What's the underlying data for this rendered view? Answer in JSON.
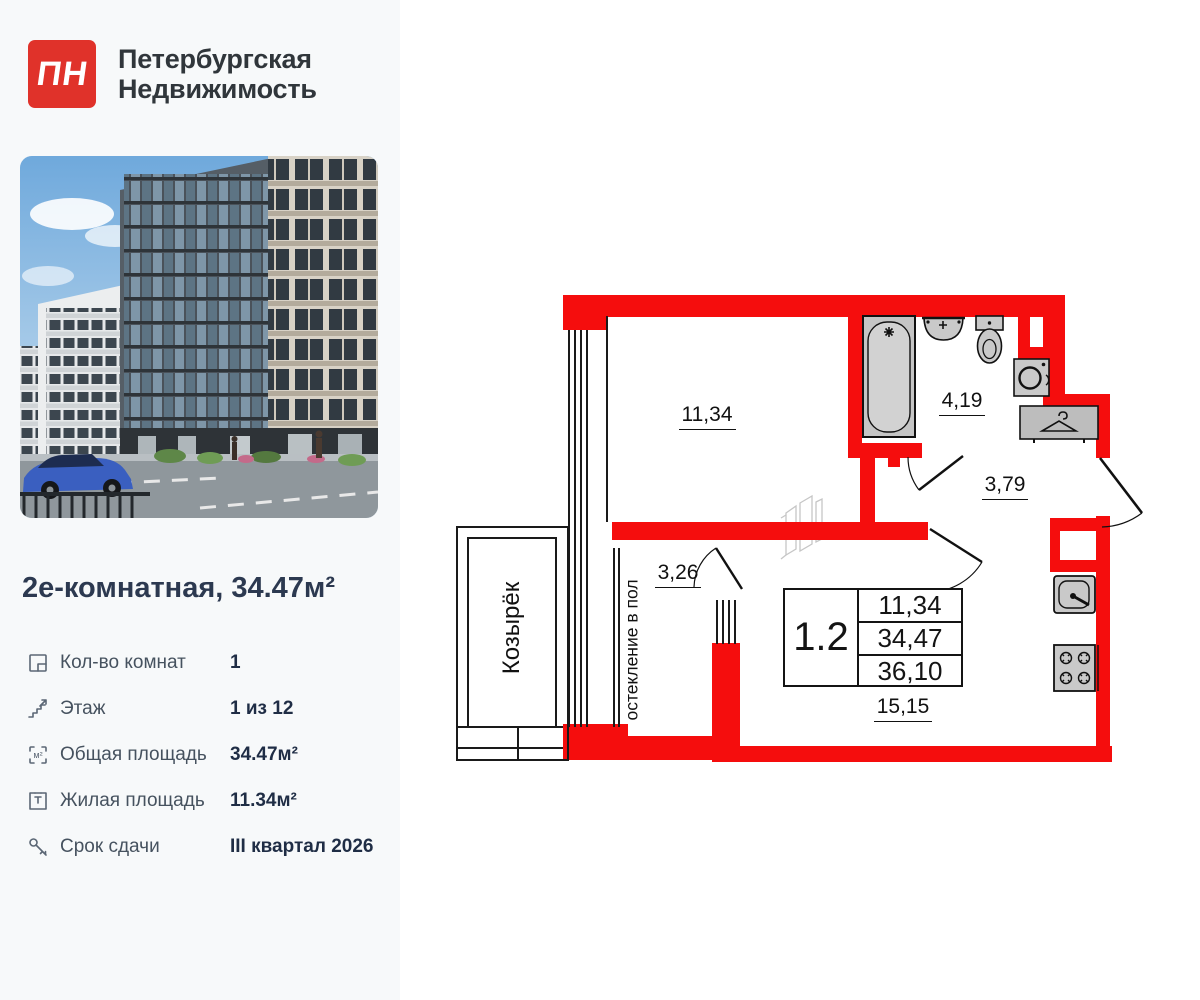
{
  "brand": {
    "logo_text": "ПН",
    "name_line1": "Петербургская",
    "name_line2": "Недвижимость"
  },
  "listing": {
    "title": "2е-комнатная, 34.47м²",
    "details": [
      {
        "icon": "rooms-icon",
        "label": "Кол-во комнат",
        "value": "1"
      },
      {
        "icon": "floor-icon",
        "label": "Этаж",
        "value": "1 из 12"
      },
      {
        "icon": "total-area-icon",
        "label": "Общая площадь",
        "value": "34.47м²"
      },
      {
        "icon": "living-area-icon",
        "label": "Жилая площадь",
        "value": "11.34м²"
      },
      {
        "icon": "key-icon",
        "label": "Срок сдачи",
        "value": "III квартал 2026"
      }
    ]
  },
  "floorplan": {
    "unit_box": {
      "unit": "1.2",
      "rows": [
        "11,34",
        "34,47",
        "36,10"
      ]
    },
    "room_labels": {
      "living": "11,34",
      "bathroom": "4,19",
      "hall": "3,79",
      "balcony": "3,26",
      "kitchen_living": "15,15"
    },
    "annotations": {
      "canopy": "Козырёк",
      "glazing": "остекление в пол"
    },
    "colors": {
      "wall": "#f50d0d",
      "fixture_fill": "#c9c9c9",
      "line": "#1a1a1a"
    }
  }
}
